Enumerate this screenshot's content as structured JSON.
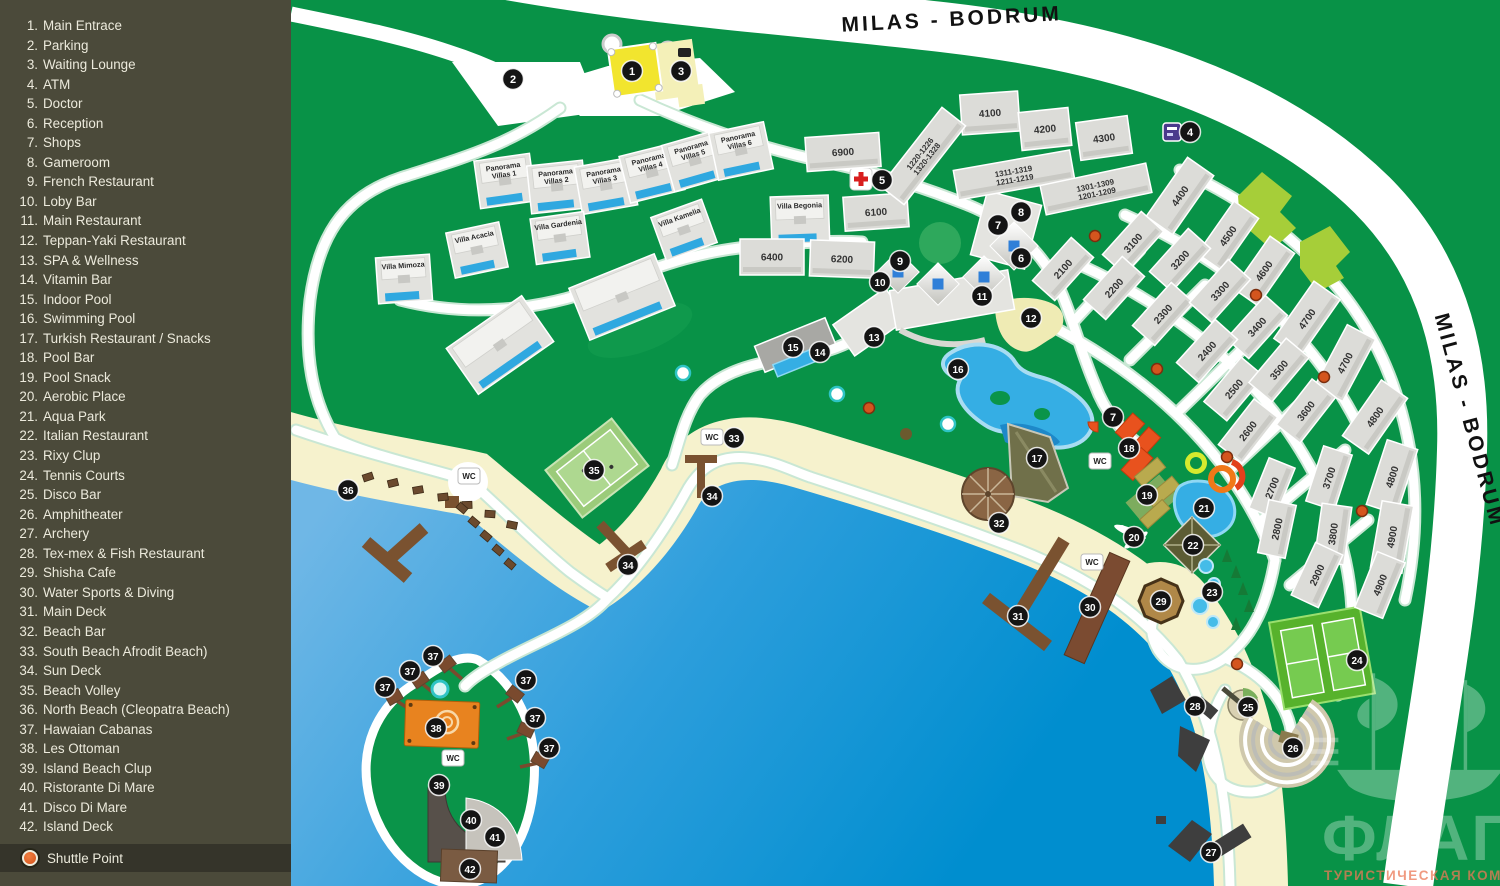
{
  "sidebar": {
    "items": [
      {
        "n": "1",
        "label": "Main Entrace"
      },
      {
        "n": "2",
        "label": "Parking"
      },
      {
        "n": "3",
        "label": "Waiting Lounge"
      },
      {
        "n": "4",
        "label": "ATM"
      },
      {
        "n": "5",
        "label": "Doctor"
      },
      {
        "n": "6",
        "label": "Reception"
      },
      {
        "n": "7",
        "label": "Shops"
      },
      {
        "n": "8",
        "label": "Gameroom"
      },
      {
        "n": "9",
        "label": "French Restaurant"
      },
      {
        "n": "10",
        "label": "Loby Bar"
      },
      {
        "n": "11",
        "label": "Main Restaurant"
      },
      {
        "n": "12",
        "label": "Teppan-Yaki Restaurant"
      },
      {
        "n": "13",
        "label": "SPA & Wellness"
      },
      {
        "n": "14",
        "label": "Vitamin Bar"
      },
      {
        "n": "15",
        "label": "Indoor Pool"
      },
      {
        "n": "16",
        "label": "Swimming Pool"
      },
      {
        "n": "17",
        "label": "Turkish Restaurant / Snacks"
      },
      {
        "n": "18",
        "label": "Pool Bar"
      },
      {
        "n": "19",
        "label": "Pool Snack"
      },
      {
        "n": "20",
        "label": "Aerobic Place"
      },
      {
        "n": "21",
        "label": "Aqua Park"
      },
      {
        "n": "22",
        "label": "Italian Restaurant"
      },
      {
        "n": "23",
        "label": "Rixy Clup"
      },
      {
        "n": "24",
        "label": "Tennis Courts"
      },
      {
        "n": "25",
        "label": "Disco Bar"
      },
      {
        "n": "26",
        "label": "Amphitheater"
      },
      {
        "n": "27",
        "label": "Archery"
      },
      {
        "n": "28",
        "label": "Tex-mex & Fish Restaurant"
      },
      {
        "n": "29",
        "label": "Shisha Cafe"
      },
      {
        "n": "30",
        "label": "Water Sports & Diving"
      },
      {
        "n": "31",
        "label": "Main Deck"
      },
      {
        "n": "32",
        "label": "Beach Bar"
      },
      {
        "n": "33",
        "label": "South Beach Afrodit Beach)"
      },
      {
        "n": "34",
        "label": "Sun Deck"
      },
      {
        "n": "35",
        "label": "Beach Volley"
      },
      {
        "n": "36",
        "label": "North Beach (Cleopatra Beach)"
      },
      {
        "n": "37",
        "label": "Hawaian Cabanas"
      },
      {
        "n": "38",
        "label": "Les Ottoman"
      },
      {
        "n": "39",
        "label": "Island Beach Clup"
      },
      {
        "n": "40",
        "label": "Ristorante Di Mare"
      },
      {
        "n": "41",
        "label": "Disco Di Mare"
      },
      {
        "n": "42",
        "label": "Island Deck"
      }
    ],
    "shuttle": {
      "label": "Shuttle Point"
    }
  },
  "map": {
    "road_labels": [
      {
        "text": "MILAS - BODRUM",
        "x": 952,
        "y": 26,
        "rot": -3
      },
      {
        "text": "MILAS - BODRUM",
        "x": 1463,
        "y": 422,
        "rot": 75
      }
    ],
    "wc_label": "WC",
    "logo": {
      "title": "ФЛАГМАН",
      "subtitle": "ТУРИСТИЧЕСКАЯ КОМПАНИЯ"
    },
    "markers": [
      [
        "1",
        632,
        71
      ],
      [
        "2",
        513,
        79
      ],
      [
        "3",
        681,
        71
      ],
      [
        "4",
        1190,
        132
      ],
      [
        "5",
        882,
        180
      ],
      [
        "6",
        1021,
        258
      ],
      [
        "7",
        998,
        225
      ],
      [
        "8",
        1021,
        212
      ],
      [
        "9",
        900,
        261
      ],
      [
        "10",
        880,
        282
      ],
      [
        "11",
        982,
        296
      ],
      [
        "12",
        1031,
        318
      ],
      [
        "13",
        874,
        337
      ],
      [
        "14",
        820,
        352
      ],
      [
        "15",
        793,
        347
      ],
      [
        "16",
        958,
        369
      ],
      [
        "7",
        1113,
        417
      ],
      [
        "17",
        1037,
        458
      ],
      [
        "18",
        1129,
        448
      ],
      [
        "19",
        1147,
        495
      ],
      [
        "20",
        1134,
        537
      ],
      [
        "21",
        1204,
        508
      ],
      [
        "22",
        1193,
        545
      ],
      [
        "23",
        1212,
        592
      ],
      [
        "24",
        1357,
        660
      ],
      [
        "25",
        1248,
        707
      ],
      [
        "26",
        1293,
        748
      ],
      [
        "27",
        1211,
        852
      ],
      [
        "28",
        1195,
        706
      ],
      [
        "29",
        1161,
        601
      ],
      [
        "30",
        1090,
        607
      ],
      [
        "31",
        1018,
        616
      ],
      [
        "32",
        999,
        523
      ],
      [
        "33",
        734,
        438
      ],
      [
        "34",
        712,
        496
      ],
      [
        "34",
        628,
        565
      ],
      [
        "35",
        594,
        470
      ],
      [
        "36",
        348,
        490
      ],
      [
        "37",
        433,
        656
      ],
      [
        "37",
        410,
        671
      ],
      [
        "37",
        385,
        687
      ],
      [
        "37",
        526,
        680
      ],
      [
        "37",
        535,
        718
      ],
      [
        "37",
        549,
        748
      ],
      [
        "38",
        436,
        728
      ],
      [
        "39",
        439,
        785
      ],
      [
        "40",
        471,
        820
      ],
      [
        "41",
        495,
        837
      ],
      [
        "42",
        470,
        869
      ]
    ],
    "wc_points": [
      [
        469,
        476
      ],
      [
        712,
        437
      ],
      [
        1100,
        461
      ],
      [
        1092,
        562
      ],
      [
        453,
        758
      ]
    ],
    "shuttle_stops": [
      [
        1095,
        236
      ],
      [
        1256,
        295
      ],
      [
        1157,
        369
      ],
      [
        1324,
        377
      ],
      [
        869,
        408
      ],
      [
        1227,
        457
      ],
      [
        1362,
        511
      ],
      [
        1237,
        664
      ]
    ],
    "villas": [
      {
        "name": "Panorama Villas 1",
        "x": 505,
        "y": 181,
        "w": 56,
        "h": 48,
        "r": -8
      },
      {
        "name": "Panorama Villas 2",
        "x": 557,
        "y": 187,
        "w": 56,
        "h": 48,
        "r": -6
      },
      {
        "name": "Panorama Villas 3",
        "x": 606,
        "y": 186,
        "w": 56,
        "h": 48,
        "r": -10
      },
      {
        "name": "Panorama Villas 4",
        "x": 652,
        "y": 173,
        "w": 56,
        "h": 48,
        "r": -14
      },
      {
        "name": "Panorama Villas 5",
        "x": 695,
        "y": 161,
        "w": 56,
        "h": 48,
        "r": -16
      },
      {
        "name": "Panorama Villas 6",
        "x": 741,
        "y": 151,
        "w": 56,
        "h": 48,
        "r": -12
      },
      {
        "name": "Villa Kamelia",
        "x": 684,
        "y": 230,
        "w": 54,
        "h": 46,
        "r": -20
      },
      {
        "name": "Villa Gardenia",
        "x": 560,
        "y": 238,
        "w": 54,
        "h": 46,
        "r": -8
      },
      {
        "name": "Villa Acacia",
        "x": 477,
        "y": 250,
        "w": 54,
        "h": 46,
        "r": -12
      },
      {
        "name": "Villa Mimoza",
        "x": 404,
        "y": 279,
        "w": 54,
        "h": 46,
        "r": -4
      },
      {
        "name": "Villa Begonia",
        "x": 800,
        "y": 220,
        "w": 58,
        "h": 48,
        "r": -2
      },
      {
        "name": "",
        "x": 500,
        "y": 345,
        "w": 92,
        "h": 56,
        "r": -35
      },
      {
        "name": "",
        "x": 622,
        "y": 297,
        "w": 92,
        "h": 56,
        "r": -22
      }
    ],
    "blocks": [
      {
        "lines": [
          "6900"
        ],
        "x": 843,
        "y": 152,
        "w": 74,
        "h": 34,
        "r": -4
      },
      {
        "lines": [
          "6100"
        ],
        "x": 876,
        "y": 212,
        "w": 64,
        "h": 34,
        "r": -4
      },
      {
        "lines": [
          "6400"
        ],
        "x": 772,
        "y": 257,
        "w": 64,
        "h": 36,
        "r": 0
      },
      {
        "lines": [
          "6200"
        ],
        "x": 842,
        "y": 259,
        "w": 64,
        "h": 36,
        "r": 2
      },
      {
        "lines": [
          "4100"
        ],
        "x": 990,
        "y": 113,
        "w": 58,
        "h": 40,
        "r": -4
      },
      {
        "lines": [
          "4200"
        ],
        "x": 1045,
        "y": 129,
        "w": 50,
        "h": 38,
        "r": -6
      },
      {
        "lines": [
          "4300"
        ],
        "x": 1104,
        "y": 138,
        "w": 52,
        "h": 38,
        "r": -8
      },
      {
        "lines": [
          "1220-1226",
          "1320-1328"
        ],
        "x": 923,
        "y": 156,
        "w": 100,
        "h": 30,
        "r": -52
      },
      {
        "lines": [
          "1311-1319",
          "1211-1219"
        ],
        "x": 1014,
        "y": 175,
        "w": 118,
        "h": 30,
        "r": -10
      },
      {
        "lines": [
          "1301-1309",
          "1201-1209"
        ],
        "x": 1096,
        "y": 189,
        "w": 108,
        "h": 30,
        "r": -12
      },
      {
        "lines": [
          "4400"
        ],
        "x": 1180,
        "y": 196,
        "w": 72,
        "h": 32,
        "r": -55
      },
      {
        "lines": [
          "4500"
        ],
        "x": 1228,
        "y": 236,
        "w": 64,
        "h": 30,
        "r": -55
      },
      {
        "lines": [
          "4600"
        ],
        "x": 1264,
        "y": 271,
        "w": 64,
        "h": 30,
        "r": -55
      },
      {
        "lines": [
          "4700"
        ],
        "x": 1307,
        "y": 319,
        "w": 70,
        "h": 32,
        "r": -55
      },
      {
        "lines": [
          "4700"
        ],
        "x": 1345,
        "y": 363,
        "w": 70,
        "h": 32,
        "r": -62
      },
      {
        "lines": [
          "2100"
        ],
        "x": 1063,
        "y": 269,
        "w": 58,
        "h": 30,
        "r": -48
      },
      {
        "lines": [
          "3100"
        ],
        "x": 1133,
        "y": 243,
        "w": 58,
        "h": 30,
        "r": -48
      },
      {
        "lines": [
          "3200"
        ],
        "x": 1180,
        "y": 260,
        "w": 58,
        "h": 30,
        "r": -48
      },
      {
        "lines": [
          "2200"
        ],
        "x": 1114,
        "y": 288,
        "w": 58,
        "h": 30,
        "r": -48
      },
      {
        "lines": [
          "2300"
        ],
        "x": 1163,
        "y": 314,
        "w": 58,
        "h": 30,
        "r": -48
      },
      {
        "lines": [
          "3300"
        ],
        "x": 1220,
        "y": 291,
        "w": 58,
        "h": 30,
        "r": -48
      },
      {
        "lines": [
          "3400"
        ],
        "x": 1257,
        "y": 327,
        "w": 58,
        "h": 30,
        "r": -48
      },
      {
        "lines": [
          "2400"
        ],
        "x": 1207,
        "y": 351,
        "w": 58,
        "h": 30,
        "r": -48
      },
      {
        "lines": [
          "2500"
        ],
        "x": 1234,
        "y": 389,
        "w": 58,
        "h": 30,
        "r": -50
      },
      {
        "lines": [
          "3500"
        ],
        "x": 1279,
        "y": 370,
        "w": 58,
        "h": 30,
        "r": -50
      },
      {
        "lines": [
          "3600"
        ],
        "x": 1306,
        "y": 411,
        "w": 58,
        "h": 30,
        "r": -52
      },
      {
        "lines": [
          "2600"
        ],
        "x": 1248,
        "y": 431,
        "w": 58,
        "h": 30,
        "r": -52
      },
      {
        "lines": [
          "2700"
        ],
        "x": 1272,
        "y": 488,
        "w": 54,
        "h": 28,
        "r": -68
      },
      {
        "lines": [
          "3700"
        ],
        "x": 1329,
        "y": 478,
        "w": 58,
        "h": 30,
        "r": -72
      },
      {
        "lines": [
          "2800"
        ],
        "x": 1277,
        "y": 529,
        "w": 54,
        "h": 28,
        "r": -78
      },
      {
        "lines": [
          "3800"
        ],
        "x": 1333,
        "y": 534,
        "w": 58,
        "h": 30,
        "r": -82
      },
      {
        "lines": [
          "2900"
        ],
        "x": 1317,
        "y": 575,
        "w": 58,
        "h": 30,
        "r": -65
      },
      {
        "lines": [
          "4800"
        ],
        "x": 1375,
        "y": 417,
        "w": 68,
        "h": 32,
        "r": -55
      },
      {
        "lines": [
          "4800"
        ],
        "x": 1392,
        "y": 477,
        "w": 68,
        "h": 32,
        "r": -72
      },
      {
        "lines": [
          "4900"
        ],
        "x": 1392,
        "y": 537,
        "w": 68,
        "h": 32,
        "r": -80
      },
      {
        "lines": [
          "4900"
        ],
        "x": 1380,
        "y": 585,
        "w": 60,
        "h": 30,
        "r": -68
      }
    ]
  },
  "colors": {
    "sidebar_bg": "#4B4A3A",
    "sidebar_text": "#ECEADC",
    "shuttle_bar": "#35342A",
    "map_green": "#089247",
    "road_white": "#FFFFFF",
    "sea_deep": "#008ECF",
    "sea_shallow": "#6FB7E6",
    "sand": "#F6F2CD",
    "building": "#DEDEDA",
    "pool_blue": "#35AEE4",
    "lime": "#A6CE39",
    "tennis_green": "#57B22C",
    "pier_brown": "#7A5230",
    "dark_structure": "#3E3E3E",
    "marker_bg": "#141414",
    "shuttle_orange": "#D4551E",
    "gate_yellow": "#F2E52E",
    "pale_yellow": "#F4F0B8"
  }
}
